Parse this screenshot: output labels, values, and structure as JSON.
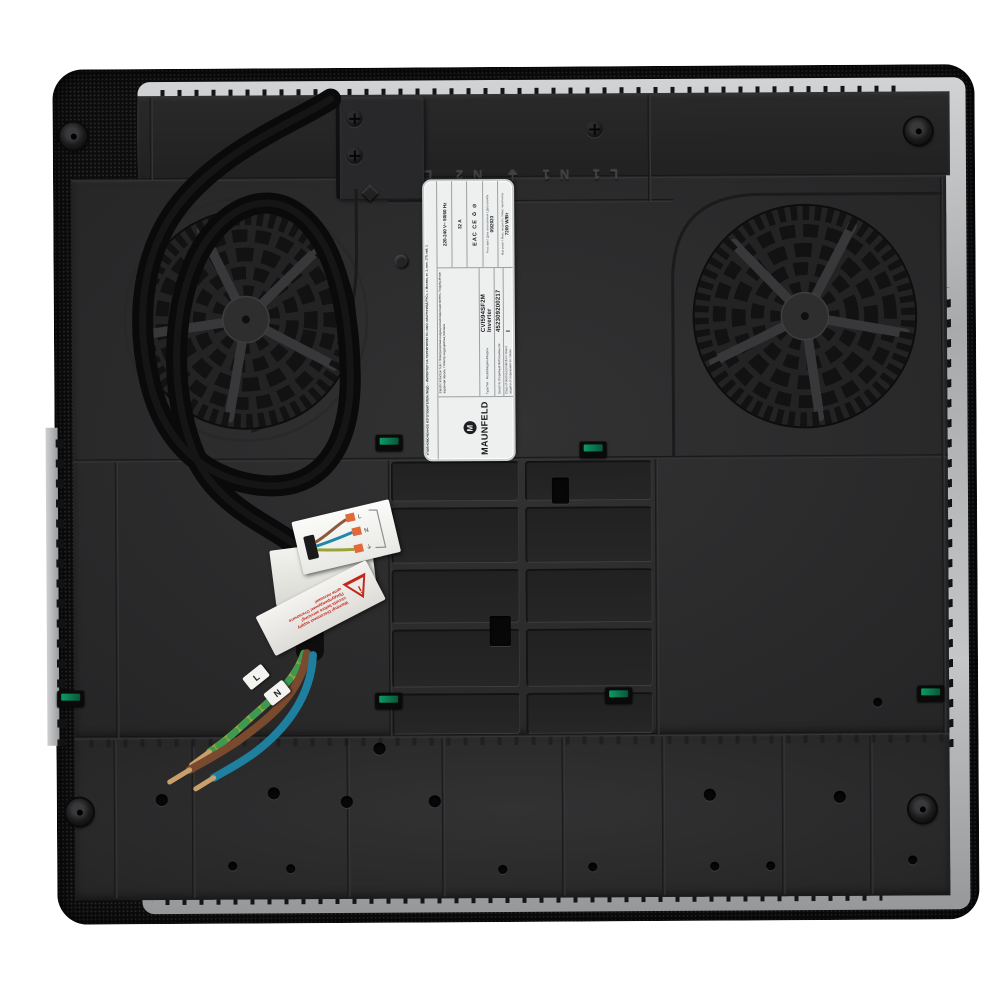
{
  "meta": {
    "description": "Underside view of a MAUNFELD built-in induction hob with two cooling fans, power cable and rating label",
    "background_color": "#ffffff"
  },
  "colors": {
    "glass_edge": "#0c0c0d",
    "base_pan": "#2b2b2c",
    "aluminium": "#b0b2b4",
    "pcb_green": "#0e9a63",
    "warning_red": "#c3271c",
    "wire_brown": "#7a4a2e",
    "wire_blue": "#1f7f9f",
    "wire_green_yellow": "#9aa23a",
    "copper": "#c9a06a"
  },
  "label": {
    "brand": "MAUNFELD",
    "logo_letter": "M",
    "importer_line": "УПОЛНОМОЧЕННОЕ ИЗГОТОВИТЕЛЕМ ЛИЦО – ИМПОРТЕР НА ТЕРРИТОРИИ ТС: ООО «МАУНФИЛД РУС», г. Москва, эт. 1, пом. 170, каб. 1",
    "product_name": "Electric Induction hob / Электрическая индукционная варочная панель / Індукцыйная варачная панэль / Электр индукциялық плитасы",
    "type_label": "Type/Тип · Model/Модель/Мадэль",
    "type_value": "CVI594SF2M Inverter",
    "serial_label": "Serial No./Серийный №/Серыйны №",
    "serial_value": "452309200217",
    "class_label": "Class of electrical protection / Класс защиты от поражения эл. током",
    "class_value": "I",
    "voltage": "220-240 V~ 50/60 Hz",
    "current": "32 A",
    "marks": "EAC CE ♻ ⊘",
    "prod_date_label": "Prod. date / Дата изготовления / Дата вырабу",
    "prod_date": "09/2023",
    "power_label": "Max power / Макс. мощность / Макс. магутнасць",
    "power": "7200 W/Вт"
  },
  "embossed_terminals": "L1 N1 ⏚ N2 L2",
  "warning_sticker": {
    "line1": "Warning! Disconnect supply",
    "line2": "circuits before servicing!",
    "line3": "Предупреждение! Отключите",
    "line4": "цепи питания!"
  },
  "wiring_sticker": {
    "terminals": [
      "L",
      "N",
      "⏚"
    ]
  },
  "wire_tags": [
    "L",
    "N"
  ]
}
